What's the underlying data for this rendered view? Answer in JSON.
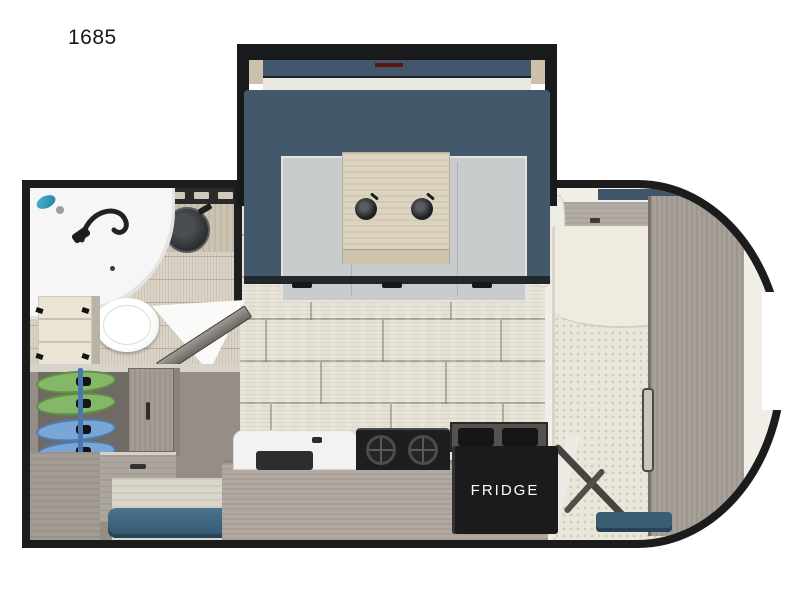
{
  "page": {
    "background_color": "#ffffff"
  },
  "floorplan": {
    "model_label": "1685",
    "kitchen": {
      "fridge_label": "FRIDGE"
    },
    "colors": {
      "outline_black": "#1c1c1c",
      "dinette_slate_blue": "#43586b",
      "dinette_cushion_gray": "#c9cccd",
      "table_wood": "#dcd4c1",
      "main_floor_plank": "#e6e1d5",
      "bathroom_floor": "#dad3c7",
      "counter_gray_wood": "#b2a9a2",
      "cabinet_gray_wood": "#a7a19a",
      "fridge_black": "#1b1b1d",
      "entry_step_teal": "#3c617a",
      "shirt_green": "#84b868",
      "shirt_blue": "#7aa6d6",
      "red_accent": "#701510",
      "mattress_cream": "#e9e6da",
      "shower_accent_teal": "#49b6d6"
    }
  }
}
